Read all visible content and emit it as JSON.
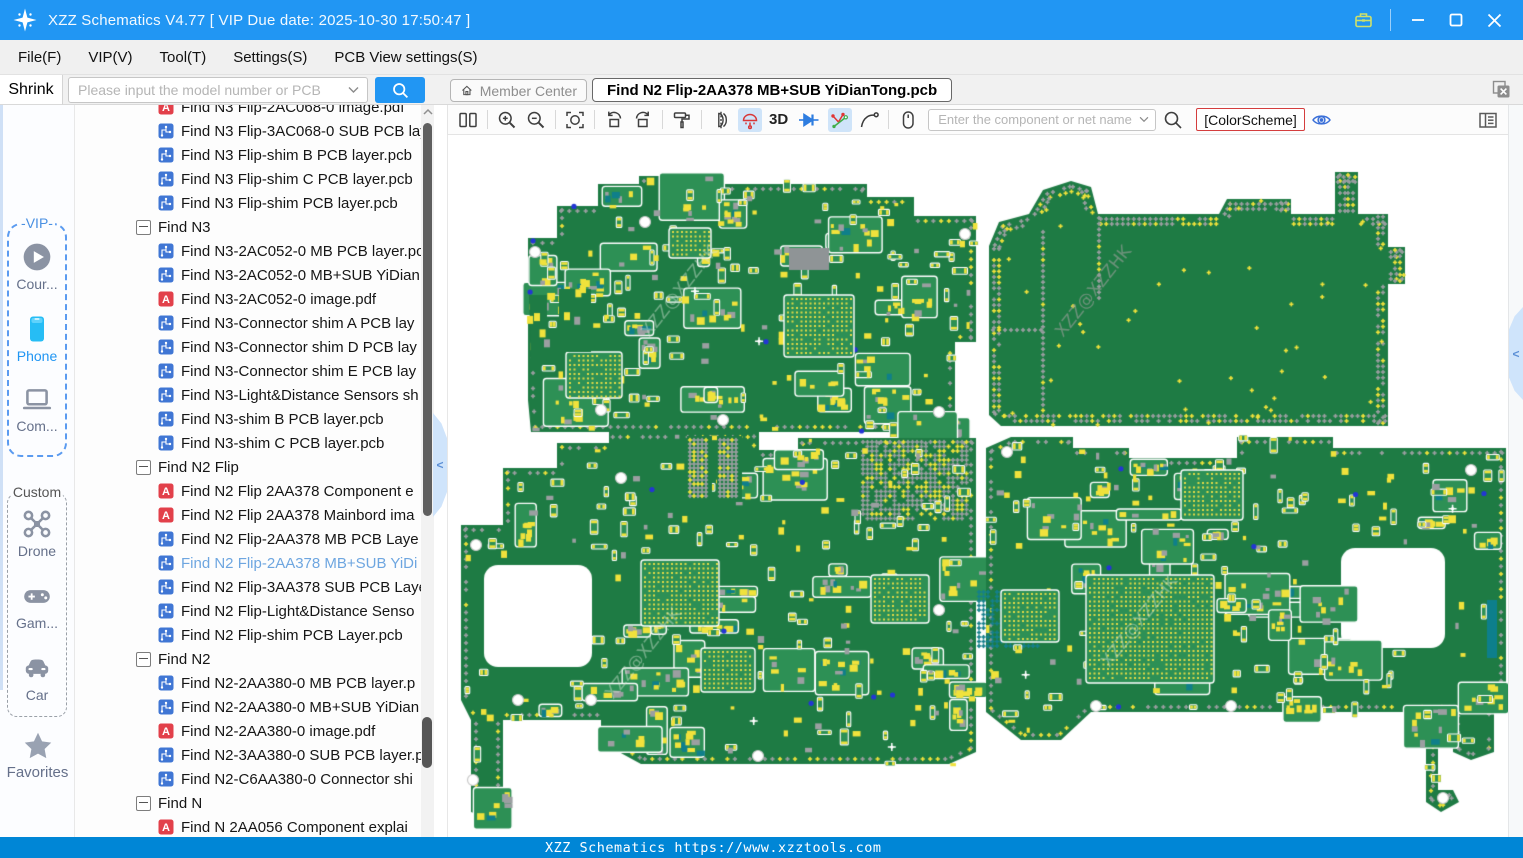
{
  "window": {
    "title": "XZZ Schematics V4.77 [ VIP Due date: 2025-10-30 17:50:47 ]"
  },
  "menu": {
    "items": [
      "File(F)",
      "VIP(V)",
      "Tool(T)",
      "Settings(S)",
      "PCB View settings(S)"
    ]
  },
  "search_row": {
    "shrink_label": "Shrink",
    "model_placeholder": "Please input the model number or PCB",
    "member_center_label": "Member Center",
    "active_tab": "Find N2 Flip-2AA378 MB+SUB YiDianTong.pcb"
  },
  "toolbar": {
    "three_d_label": "3D",
    "net_placeholder": "Enter the component or net name",
    "color_scheme_label": "[ColorScheme]"
  },
  "sidebar": {
    "vip_group_label": "-VIP-",
    "custom_group_label": "Custom",
    "favorites_label": "Favorites",
    "items": [
      {
        "id": "course",
        "label": "Cour..."
      },
      {
        "id": "phone",
        "label": "Phone",
        "active": true
      },
      {
        "id": "computer",
        "label": "Com..."
      },
      {
        "id": "drone",
        "label": "Drone"
      },
      {
        "id": "game",
        "label": "Gam..."
      },
      {
        "id": "car",
        "label": "Car"
      }
    ]
  },
  "tree": {
    "items": [
      {
        "type": "pdf",
        "label": "Find N3 Flip-2AC068-0 image.pdf"
      },
      {
        "type": "pcb",
        "label": "Find N3 Flip-3AC068-0 SUB PCB lay"
      },
      {
        "type": "pcb",
        "label": "Find N3 Flip-shim B PCB layer.pcb"
      },
      {
        "type": "pcb",
        "label": "Find N3 Flip-shim C PCB layer.pcb"
      },
      {
        "type": "pcb",
        "label": "Find N3 Flip-shim PCB layer.pcb"
      },
      {
        "type": "group",
        "label": "Find N3"
      },
      {
        "type": "pcb",
        "label": "Find N3-2AC052-0 MB PCB layer.pc"
      },
      {
        "type": "pcb",
        "label": "Find N3-2AC052-0 MB+SUB YiDian"
      },
      {
        "type": "pdf",
        "label": "Find N3-2AC052-0 image.pdf"
      },
      {
        "type": "pcb",
        "label": "Find N3-Connector shim A PCB lay"
      },
      {
        "type": "pcb",
        "label": "Find N3-Connector shim D PCB lay"
      },
      {
        "type": "pcb",
        "label": "Find N3-Connector shim E PCB lay"
      },
      {
        "type": "pcb",
        "label": "Find N3-Light&Distance Sensors sh"
      },
      {
        "type": "pcb",
        "label": "Find N3-shim B PCB layer.pcb"
      },
      {
        "type": "pcb",
        "label": "Find N3-shim C PCB layer.pcb"
      },
      {
        "type": "group",
        "label": "Find N2 Flip"
      },
      {
        "type": "pdf",
        "label": "Find N2 Flip 2AA378 Component e"
      },
      {
        "type": "pdf",
        "label": "Find N2 Flip 2AA378 Mainbord ima"
      },
      {
        "type": "pcb",
        "label": "Find N2 Flip-2AA378 MB PCB Laye"
      },
      {
        "type": "pcb",
        "label": "Find N2 Flip-2AA378 MB+SUB YiDi",
        "selected": true
      },
      {
        "type": "pcb",
        "label": "Find N2 Flip-3AA378 SUB PCB Laye"
      },
      {
        "type": "pcb",
        "label": "Find N2 Flip-Light&Distance Senso"
      },
      {
        "type": "pcb",
        "label": "Find N2 Flip-shim PCB Layer.pcb"
      },
      {
        "type": "group",
        "label": "Find N2"
      },
      {
        "type": "pcb",
        "label": "Find N2-2AA380-0 MB PCB layer.p"
      },
      {
        "type": "pcb",
        "label": "Find N2-2AA380-0 MB+SUB YiDian"
      },
      {
        "type": "pdf",
        "label": "Find N2-2AA380-0 image.pdf"
      },
      {
        "type": "pcb",
        "label": "Find N2-3AA380-0 SUB PCB layer.p"
      },
      {
        "type": "pcb",
        "label": "Find N2-C6AA380-0 Connector shi"
      },
      {
        "type": "group",
        "label": "Find N"
      },
      {
        "type": "pdf",
        "label": "Find N 2AA056 Component explai"
      }
    ]
  },
  "statusbar": {
    "text": "XZZ Schematics https://www.xzztools.com"
  },
  "colors": {
    "titlebar": "#2196f3",
    "statusbar": "#0086d6",
    "accent": "#2196f3",
    "board_green": "#1e7b44",
    "cluster_green": "#2d9055",
    "pad_yellow": "#f0e23c",
    "pad_gray": "#9b9fa1",
    "via_blue": "#2336d4",
    "selected_tree_item": "#6ea6e0",
    "active_tool_bg": "#cfe4f9",
    "colorscheme_border": "#d43d3d"
  },
  "pcb_view": {
    "watermark": "XZZ@XZZHK",
    "boards": [
      {
        "name": "mainboard-top",
        "style": "dense",
        "seed": 7,
        "pts": [
          [
            527,
            238
          ],
          [
            556,
            238
          ],
          [
            556,
            206
          ],
          [
            597,
            206
          ],
          [
            597,
            184
          ],
          [
            638,
            184
          ],
          [
            638,
            176
          ],
          [
            658,
            176
          ],
          [
            658,
            184
          ],
          [
            866,
            184
          ],
          [
            866,
            197
          ],
          [
            913,
            197
          ],
          [
            913,
            216
          ],
          [
            975,
            216
          ],
          [
            975,
            342
          ],
          [
            954,
            342
          ],
          [
            954,
            432
          ],
          [
            530,
            432
          ],
          [
            527,
            400
          ]
        ],
        "holes": [],
        "screws": [
          [
            644,
            222
          ],
          [
            534,
            252
          ],
          [
            964,
            234
          ],
          [
            722,
            420
          ],
          [
            938,
            412
          ],
          [
            600,
            410
          ]
        ],
        "bgas": [
          [
            783,
            295,
            70,
            62
          ],
          [
            565,
            352,
            56,
            46
          ],
          [
            668,
            228,
            42,
            30
          ]
        ],
        "extras": [
          [
            788,
            248,
            40,
            22,
            "#8f9496"
          ]
        ],
        "wm": [
          648,
          338,
          17
        ]
      },
      {
        "name": "mainboard-plain",
        "style": "plain",
        "seed": 11,
        "pts": [
          [
            988,
            246
          ],
          [
            998,
            222
          ],
          [
            1028,
            214
          ],
          [
            1042,
            190
          ],
          [
            1070,
            181
          ],
          [
            1090,
            187
          ],
          [
            1097,
            214
          ],
          [
            1218,
            214
          ],
          [
            1226,
            199
          ],
          [
            1290,
            199
          ],
          [
            1290,
            214
          ],
          [
            1334,
            214
          ],
          [
            1334,
            172
          ],
          [
            1357,
            172
          ],
          [
            1357,
            214
          ],
          [
            1387,
            214
          ],
          [
            1387,
            247
          ],
          [
            1404,
            247
          ],
          [
            1404,
            284
          ],
          [
            1387,
            284
          ],
          [
            1387,
            426
          ],
          [
            1000,
            426
          ],
          [
            988,
            415
          ]
        ],
        "holes": [],
        "screws": [],
        "bgas": [],
        "extras": [],
        "crosslines": [
          [
            1042,
            232,
            1042,
            416
          ],
          [
            992,
            330,
            1040,
            330
          ],
          [
            1098,
            218,
            1098,
            298
          ]
        ],
        "wm": [
          1062,
          338,
          17
        ]
      },
      {
        "name": "sub-top",
        "style": "dense",
        "seed": 23,
        "pts": [
          [
            460,
            525
          ],
          [
            502,
            525
          ],
          [
            502,
            468
          ],
          [
            556,
            468
          ],
          [
            556,
            443
          ],
          [
            608,
            443
          ],
          [
            608,
            432
          ],
          [
            758,
            432
          ],
          [
            758,
            450
          ],
          [
            797,
            450
          ],
          [
            797,
            438
          ],
          [
            975,
            438
          ],
          [
            975,
            752
          ],
          [
            948,
            764
          ],
          [
            640,
            764
          ],
          [
            618,
            752
          ],
          [
            618,
            745
          ],
          [
            600,
            745
          ],
          [
            600,
            720
          ],
          [
            502,
            720
          ],
          [
            502,
            812
          ],
          [
            492,
            820
          ],
          [
            470,
            812
          ],
          [
            470,
            720
          ],
          [
            460,
            700
          ]
        ],
        "holes": [
          [
            483,
            565,
            108,
            102,
            14
          ]
        ],
        "screws": [
          [
            517,
            700
          ],
          [
            590,
            700
          ],
          [
            472,
            780
          ],
          [
            620,
            478
          ],
          [
            938,
            610
          ],
          [
            757,
            756
          ],
          [
            475,
            545
          ]
        ],
        "bgas": [
          [
            640,
            560,
            78,
            66
          ],
          [
            870,
            575,
            58,
            48
          ],
          [
            700,
            648,
            54,
            44
          ]
        ],
        "extras": [],
        "crossfields": [
          [
            862,
            442,
            106,
            78,
            "std"
          ]
        ],
        "wm": [
          612,
          700,
          17
        ]
      },
      {
        "name": "sub-bottom",
        "style": "dense",
        "seed": 41,
        "pts": [
          [
            985,
            448
          ],
          [
            1010,
            437
          ],
          [
            1072,
            437
          ],
          [
            1072,
            448
          ],
          [
            1128,
            448
          ],
          [
            1128,
            458
          ],
          [
            1236,
            458
          ],
          [
            1236,
            437
          ],
          [
            1332,
            437
          ],
          [
            1332,
            448
          ],
          [
            1505,
            448
          ],
          [
            1505,
            700
          ],
          [
            1493,
            710
          ],
          [
            1493,
            752
          ],
          [
            1470,
            760
          ],
          [
            1452,
            752
          ],
          [
            1452,
            712
          ],
          [
            1437,
            712
          ],
          [
            1437,
            790
          ],
          [
            1452,
            790
          ],
          [
            1458,
            802
          ],
          [
            1440,
            812
          ],
          [
            1425,
            802
          ],
          [
            1425,
            712
          ],
          [
            1090,
            712
          ],
          [
            1060,
            740
          ],
          [
            1020,
            740
          ],
          [
            985,
            712
          ]
        ],
        "holes": [
          [
            1340,
            548,
            104,
            100,
            14
          ]
        ],
        "screws": [
          [
            1006,
            452
          ],
          [
            1095,
            706
          ],
          [
            1230,
            706
          ],
          [
            1442,
            798
          ],
          [
            1470,
            470
          ]
        ],
        "bgas": [
          [
            1085,
            575,
            128,
            108
          ],
          [
            1180,
            470,
            62,
            50
          ],
          [
            1000,
            590,
            58,
            52
          ]
        ],
        "extras": [
          [
            1486,
            600,
            10,
            58,
            "#0d7f8c"
          ]
        ],
        "crossfields": [
          [
            978,
            592,
            62,
            58,
            "teal"
          ]
        ],
        "wm": [
          1108,
          668,
          17
        ]
      },
      {
        "name": "shim-strip-a",
        "style": "strip",
        "seed": 5,
        "pts": [
          [
            528,
            295
          ],
          [
            546,
            295
          ],
          [
            546,
            360
          ],
          [
            539,
            368
          ],
          [
            530,
            360
          ]
        ],
        "holes": [],
        "screws": [],
        "bgas": [],
        "extras": []
      },
      {
        "name": "shim-strip-b",
        "style": "strip",
        "seed": 6,
        "pts": [
          [
            558,
            289
          ],
          [
            590,
            289
          ],
          [
            590,
            352
          ],
          [
            558,
            352
          ]
        ],
        "holes": [],
        "screws": [],
        "bgas": [],
        "extras": []
      },
      {
        "name": "connector-comb-a",
        "style": "comb",
        "seed": 8,
        "pts": [
          [
            686,
            436
          ],
          [
            711,
            436
          ],
          [
            711,
            500
          ],
          [
            686,
            500
          ]
        ],
        "holes": [],
        "screws": [],
        "bgas": [],
        "extras": []
      },
      {
        "name": "connector-comb-b",
        "style": "comb",
        "seed": 9,
        "pts": [
          [
            716,
            436
          ],
          [
            741,
            436
          ],
          [
            741,
            500
          ],
          [
            716,
            500
          ]
        ],
        "holes": [],
        "screws": [],
        "bgas": [],
        "extras": []
      }
    ]
  }
}
